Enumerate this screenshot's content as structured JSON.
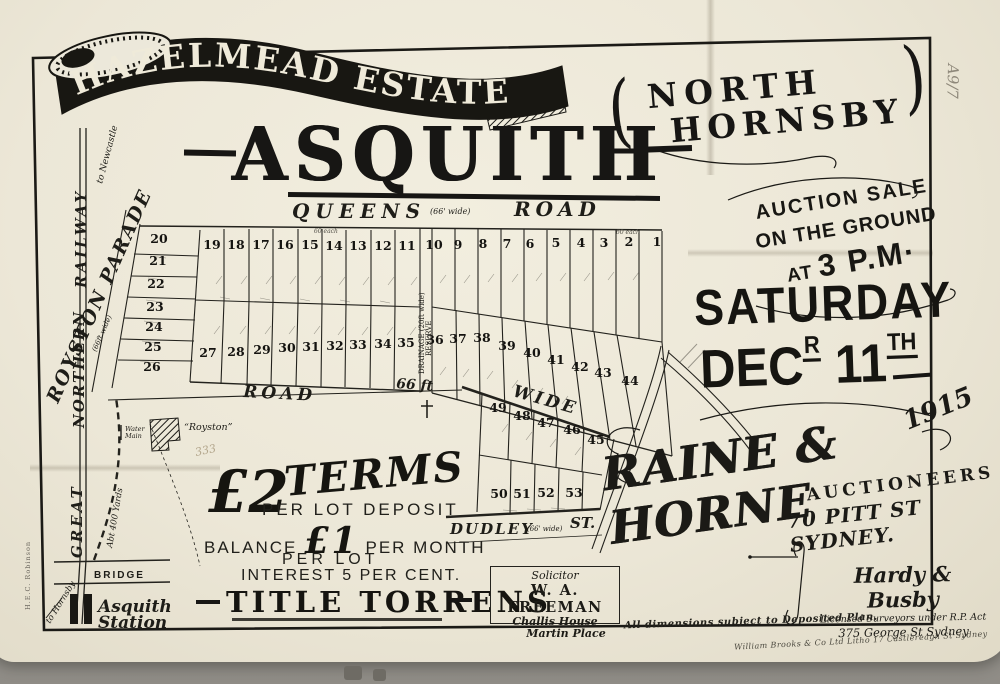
{
  "photo": {
    "catalog_pencil": "A9/7"
  },
  "title": {
    "banner": "HAZELMEAD ESTATE",
    "paren_open": "(",
    "paren_close": ")",
    "sub1": "NORTH",
    "sub2": "HORNSBY",
    "main": "ASQUITH"
  },
  "auction": {
    "l1": "AUCTION SALE",
    "l2": "ON THE GROUND",
    "at": "AT",
    "time": "3 P.M·",
    "day": "SATURDAY",
    "dec": "DEC",
    "dec_sup": "R",
    "day_num": "11",
    "num_sup": "TH",
    "year": "1915",
    "firm": "RAINE & HORNE",
    "firm_role": "AUCTIONEERS",
    "firm_addr": "70 PITT ST SYDNEY."
  },
  "terms": {
    "heading": "TERMS",
    "deposit_amount": "£2",
    "deposit_line": "PER LOT DEPOSIT",
    "balance_pre": "BALANCE",
    "balance_amount": "£1",
    "balance_post": "PER MONTH",
    "per_lot": "PER LOT",
    "interest": "INTEREST 5 PER CENT.",
    "title_line": "TITLE TORRENS"
  },
  "solicitor": {
    "role": "Solicitor",
    "name": "W. A. FREEMAN",
    "addr1": "Challis House",
    "addr2": "Martin Place"
  },
  "surveyors": {
    "name": "Hardy & Busby",
    "desc": "Licensed Surveyors under R.P. Act",
    "addr": "375 George St Sydney"
  },
  "notes": {
    "dimensions": "All dimensions subject to Deposited Plan.",
    "printer": "William Brooks & Co Ltd Litho 17 Castlereagh St Sydney",
    "map_seller": "H.E.C. Robinson"
  },
  "map": {
    "queens": "QUEENS",
    "queens_width": "(66' wide)",
    "queens_road": "ROAD",
    "mid_road": "ROAD",
    "mid_width": "66 ft",
    "mid_wide": "WIDE",
    "dudley": "DUDLEY",
    "dudley_width": "(66' wide)",
    "dudley_st": "ST.",
    "royston_parade": "ROYSTON PARADE",
    "royston_width": "(66ft wide)",
    "drainage": "DRAINAGE (20ft wide)",
    "reserve": "RESERVE",
    "railway": {
      "great": "GREAT",
      "northern": "NORTHERN",
      "railway": "RAILWAY",
      "to_newcastle": "to Newcastle",
      "to_hornsby": "to Hornsby",
      "bridge": "BRIDGE",
      "station_1": "Asquith",
      "station_2": "Station",
      "distance": "Abt 400 Yards"
    },
    "landmarks": {
      "water_1": "Water",
      "water_2": "Main",
      "house": "“Royston”",
      "pencil": "333",
      "each_1": "60 each",
      "each_2": "60 each"
    },
    "lots": [
      {
        "n": "20",
        "x": 159,
        "y": 243
      },
      {
        "n": "21",
        "x": 158,
        "y": 265
      },
      {
        "n": "22",
        "x": 156,
        "y": 288
      },
      {
        "n": "23",
        "x": 155,
        "y": 311
      },
      {
        "n": "24",
        "x": 154,
        "y": 331
      },
      {
        "n": "25",
        "x": 153,
        "y": 351
      },
      {
        "n": "26",
        "x": 152,
        "y": 371
      },
      {
        "n": "19",
        "x": 212,
        "y": 249
      },
      {
        "n": "18",
        "x": 236,
        "y": 249
      },
      {
        "n": "17",
        "x": 261,
        "y": 249
      },
      {
        "n": "16",
        "x": 285,
        "y": 249
      },
      {
        "n": "15",
        "x": 310,
        "y": 249
      },
      {
        "n": "14",
        "x": 334,
        "y": 250
      },
      {
        "n": "13",
        "x": 358,
        "y": 250
      },
      {
        "n": "12",
        "x": 383,
        "y": 250
      },
      {
        "n": "11",
        "x": 407,
        "y": 250
      },
      {
        "n": "10",
        "x": 434,
        "y": 249
      },
      {
        "n": "9",
        "x": 458,
        "y": 249
      },
      {
        "n": "8",
        "x": 483,
        "y": 248
      },
      {
        "n": "7",
        "x": 507,
        "y": 248
      },
      {
        "n": "6",
        "x": 530,
        "y": 248
      },
      {
        "n": "5",
        "x": 556,
        "y": 247
      },
      {
        "n": "4",
        "x": 581,
        "y": 247
      },
      {
        "n": "3",
        "x": 604,
        "y": 247
      },
      {
        "n": "2",
        "x": 629,
        "y": 246
      },
      {
        "n": "1",
        "x": 657,
        "y": 246
      },
      {
        "n": "27",
        "x": 208,
        "y": 357
      },
      {
        "n": "28",
        "x": 236,
        "y": 356
      },
      {
        "n": "29",
        "x": 262,
        "y": 354
      },
      {
        "n": "30",
        "x": 287,
        "y": 352
      },
      {
        "n": "31",
        "x": 311,
        "y": 351
      },
      {
        "n": "32",
        "x": 335,
        "y": 350
      },
      {
        "n": "33",
        "x": 358,
        "y": 349
      },
      {
        "n": "34",
        "x": 383,
        "y": 348
      },
      {
        "n": "35",
        "x": 406,
        "y": 347
      },
      {
        "n": "36",
        "x": 435,
        "y": 344
      },
      {
        "n": "37",
        "x": 458,
        "y": 343
      },
      {
        "n": "38",
        "x": 482,
        "y": 342
      },
      {
        "n": "39",
        "x": 507,
        "y": 350
      },
      {
        "n": "40",
        "x": 532,
        "y": 357
      },
      {
        "n": "41",
        "x": 556,
        "y": 364
      },
      {
        "n": "42",
        "x": 580,
        "y": 371
      },
      {
        "n": "43",
        "x": 603,
        "y": 377
      },
      {
        "n": "44",
        "x": 630,
        "y": 385
      },
      {
        "n": "49",
        "x": 498,
        "y": 412
      },
      {
        "n": "48",
        "x": 522,
        "y": 420
      },
      {
        "n": "47",
        "x": 546,
        "y": 427
      },
      {
        "n": "46",
        "x": 572,
        "y": 434
      },
      {
        "n": "45",
        "x": 596,
        "y": 444
      },
      {
        "n": "50",
        "x": 499,
        "y": 498
      },
      {
        "n": "51",
        "x": 522,
        "y": 498
      },
      {
        "n": "52",
        "x": 546,
        "y": 497
      },
      {
        "n": "53",
        "x": 574,
        "y": 497
      }
    ]
  }
}
